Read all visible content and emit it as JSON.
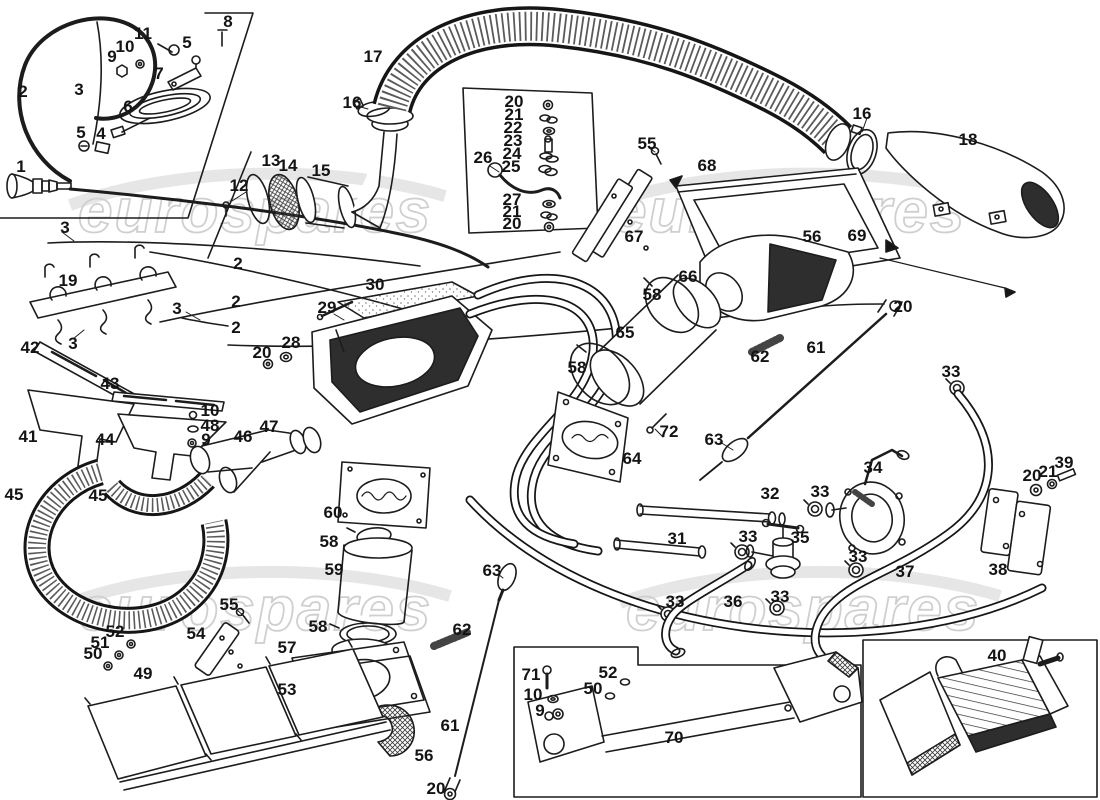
{
  "diagram": {
    "description": "Exploded parts diagram of a car heating and ventilation system",
    "part_labels": [
      {
        "text": "1",
        "x": 21,
        "y": 172
      },
      {
        "text": "2",
        "x": 23,
        "y": 97
      },
      {
        "text": "3",
        "x": 79,
        "y": 95
      },
      {
        "text": "5",
        "x": 187,
        "y": 48
      },
      {
        "text": "8",
        "x": 228,
        "y": 27
      },
      {
        "text": "11",
        "x": 143,
        "y": 39
      },
      {
        "text": "10",
        "x": 125,
        "y": 52
      },
      {
        "text": "9",
        "x": 112,
        "y": 62
      },
      {
        "text": "7",
        "x": 159,
        "y": 79
      },
      {
        "text": "6",
        "x": 128,
        "y": 112
      },
      {
        "text": "5",
        "x": 81,
        "y": 138
      },
      {
        "text": "4",
        "x": 101,
        "y": 139
      },
      {
        "text": "12",
        "x": 239,
        "y": 191
      },
      {
        "text": "13",
        "x": 271,
        "y": 166
      },
      {
        "text": "14",
        "x": 288,
        "y": 171
      },
      {
        "text": "15",
        "x": 321,
        "y": 176
      },
      {
        "text": "16",
        "x": 352,
        "y": 108
      },
      {
        "text": "17",
        "x": 373,
        "y": 62
      },
      {
        "text": "16",
        "x": 862,
        "y": 119
      },
      {
        "text": "18",
        "x": 968,
        "y": 145
      },
      {
        "text": "3",
        "x": 65,
        "y": 233
      },
      {
        "text": "19",
        "x": 68,
        "y": 286
      },
      {
        "text": "2",
        "x": 238,
        "y": 269
      },
      {
        "text": "2",
        "x": 236,
        "y": 307
      },
      {
        "text": "3",
        "x": 177,
        "y": 314
      },
      {
        "text": "2",
        "x": 236,
        "y": 333
      },
      {
        "text": "3",
        "x": 73,
        "y": 349
      },
      {
        "text": "20",
        "x": 262,
        "y": 358
      },
      {
        "text": "28",
        "x": 291,
        "y": 348
      },
      {
        "text": "29",
        "x": 327,
        "y": 313
      },
      {
        "text": "30",
        "x": 375,
        "y": 290
      },
      {
        "text": "42",
        "x": 30,
        "y": 353
      },
      {
        "text": "43",
        "x": 110,
        "y": 389
      },
      {
        "text": "41",
        "x": 28,
        "y": 442
      },
      {
        "text": "44",
        "x": 105,
        "y": 445
      },
      {
        "text": "10",
        "x": 210,
        "y": 416
      },
      {
        "text": "48",
        "x": 210,
        "y": 431
      },
      {
        "text": "9",
        "x": 206,
        "y": 445
      },
      {
        "text": "46",
        "x": 243,
        "y": 442
      },
      {
        "text": "47",
        "x": 269,
        "y": 432
      },
      {
        "text": "45",
        "x": 14,
        "y": 500
      },
      {
        "text": "45",
        "x": 98,
        "y": 501
      },
      {
        "text": "20",
        "x": 514,
        "y": 107
      },
      {
        "text": "21",
        "x": 514,
        "y": 120
      },
      {
        "text": "22",
        "x": 513,
        "y": 133
      },
      {
        "text": "23",
        "x": 513,
        "y": 146
      },
      {
        "text": "24",
        "x": 512,
        "y": 159
      },
      {
        "text": "25",
        "x": 511,
        "y": 172
      },
      {
        "text": "26",
        "x": 483,
        "y": 163
      },
      {
        "text": "27",
        "x": 512,
        "y": 205
      },
      {
        "text": "21",
        "x": 512,
        "y": 217
      },
      {
        "text": "20",
        "x": 512,
        "y": 229
      },
      {
        "text": "55",
        "x": 647,
        "y": 149
      },
      {
        "text": "68",
        "x": 707,
        "y": 171
      },
      {
        "text": "67",
        "x": 634,
        "y": 242
      },
      {
        "text": "56",
        "x": 812,
        "y": 242
      },
      {
        "text": "69",
        "x": 857,
        "y": 241
      },
      {
        "text": "66",
        "x": 688,
        "y": 282
      },
      {
        "text": "58",
        "x": 652,
        "y": 300
      },
      {
        "text": "20",
        "x": 903,
        "y": 312
      },
      {
        "text": "65",
        "x": 625,
        "y": 338
      },
      {
        "text": "58",
        "x": 577,
        "y": 373
      },
      {
        "text": "61",
        "x": 816,
        "y": 353
      },
      {
        "text": "62",
        "x": 760,
        "y": 362
      },
      {
        "text": "33",
        "x": 951,
        "y": 377
      },
      {
        "text": "72",
        "x": 669,
        "y": 437
      },
      {
        "text": "64",
        "x": 632,
        "y": 464
      },
      {
        "text": "63",
        "x": 714,
        "y": 445
      },
      {
        "text": "60",
        "x": 333,
        "y": 518
      },
      {
        "text": "58",
        "x": 329,
        "y": 547
      },
      {
        "text": "59",
        "x": 334,
        "y": 575
      },
      {
        "text": "58",
        "x": 318,
        "y": 632
      },
      {
        "text": "55",
        "x": 229,
        "y": 610
      },
      {
        "text": "54",
        "x": 196,
        "y": 639
      },
      {
        "text": "52",
        "x": 115,
        "y": 637
      },
      {
        "text": "51",
        "x": 100,
        "y": 648
      },
      {
        "text": "50",
        "x": 93,
        "y": 659
      },
      {
        "text": "49",
        "x": 143,
        "y": 679
      },
      {
        "text": "57",
        "x": 287,
        "y": 653
      },
      {
        "text": "53",
        "x": 287,
        "y": 695
      },
      {
        "text": "56",
        "x": 424,
        "y": 761
      },
      {
        "text": "63",
        "x": 492,
        "y": 576
      },
      {
        "text": "62",
        "x": 462,
        "y": 635
      },
      {
        "text": "61",
        "x": 450,
        "y": 731
      },
      {
        "text": "20",
        "x": 436,
        "y": 794
      },
      {
        "text": "71",
        "x": 531,
        "y": 680
      },
      {
        "text": "10",
        "x": 533,
        "y": 700
      },
      {
        "text": "9",
        "x": 540,
        "y": 716
      },
      {
        "text": "52",
        "x": 608,
        "y": 678
      },
      {
        "text": "50",
        "x": 593,
        "y": 694
      },
      {
        "text": "70",
        "x": 674,
        "y": 743
      },
      {
        "text": "31",
        "x": 677,
        "y": 544
      },
      {
        "text": "32",
        "x": 770,
        "y": 499
      },
      {
        "text": "33",
        "x": 820,
        "y": 497
      },
      {
        "text": "34",
        "x": 873,
        "y": 473
      },
      {
        "text": "33",
        "x": 748,
        "y": 542
      },
      {
        "text": "35",
        "x": 800,
        "y": 543
      },
      {
        "text": "33",
        "x": 858,
        "y": 562
      },
      {
        "text": "36",
        "x": 733,
        "y": 607
      },
      {
        "text": "33",
        "x": 675,
        "y": 607
      },
      {
        "text": "33",
        "x": 780,
        "y": 602
      },
      {
        "text": "37",
        "x": 905,
        "y": 577
      },
      {
        "text": "38",
        "x": 998,
        "y": 575
      },
      {
        "text": "20",
        "x": 1032,
        "y": 481
      },
      {
        "text": "21",
        "x": 1048,
        "y": 477
      },
      {
        "text": "39",
        "x": 1064,
        "y": 468
      },
      {
        "text": "40",
        "x": 997,
        "y": 661
      }
    ]
  },
  "watermark": {
    "text": "eurospares",
    "color": "#cfcfcf",
    "instances": [
      {
        "x": 78,
        "y": 232
      },
      {
        "x": 612,
        "y": 232
      },
      {
        "x": 78,
        "y": 630
      },
      {
        "x": 626,
        "y": 630
      }
    ]
  }
}
